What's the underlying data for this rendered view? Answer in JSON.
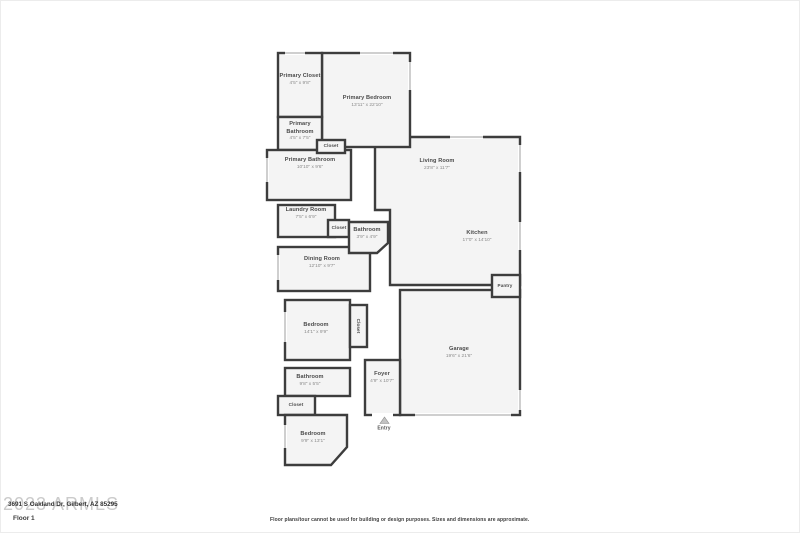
{
  "page": {
    "address": "3691 S Oakland Dr, Gilbert, AZ 85295",
    "floor_label": "Floor 1",
    "watermark": "2023 ARMLS",
    "entry_label": "Entry",
    "disclaimer": "Floor plans/tour cannot be used for building or design purposes. Sizes and dimensions are approximate."
  },
  "colors": {
    "wall": "#3d3d3d",
    "room_fill": "#f4f4f4",
    "window_line": "#9f9f9f",
    "watermark": "#cbcbcb",
    "label_text": "#4a4a4a",
    "dims_text": "#8a8a8a"
  },
  "rooms": [
    {
      "name": "Primary Closet",
      "dims": "4'5\" x 9'8\""
    },
    {
      "name": "Primary Bedroom",
      "dims": "13'11\" x 22'10\""
    },
    {
      "name": "Primary Bathroom",
      "dims": "4'5\" x 7'5\""
    },
    {
      "name": "Closet",
      "dims": ""
    },
    {
      "name": "Primary Bathroom",
      "dims": "10'10\" x 9'6\""
    },
    {
      "name": "Laundry Room",
      "dims": "7'5\" x 6'9\""
    },
    {
      "name": "Closet",
      "dims": ""
    },
    {
      "name": "Bathroom",
      "dims": "3'9\" x 4'9\""
    },
    {
      "name": "Living Room",
      "dims": "23'8\" x 11'7\""
    },
    {
      "name": "Kitchen",
      "dims": "17'0\" x 14'10\""
    },
    {
      "name": "Pantry",
      "dims": ""
    },
    {
      "name": "Dining Room",
      "dims": "12'10\" x 9'7\""
    },
    {
      "name": "Bedroom",
      "dims": "14'1\" x 9'9\""
    },
    {
      "name": "Closet",
      "dims": ""
    },
    {
      "name": "Garage",
      "dims": "19'6\" x 21'6\""
    },
    {
      "name": "Foyer",
      "dims": "4'9\" x 10'7\""
    },
    {
      "name": "Bathroom",
      "dims": "9'8\" x 5'5\""
    },
    {
      "name": "Closet",
      "dims": ""
    },
    {
      "name": "Bedroom",
      "dims": "9'9\" x 13'1\""
    }
  ]
}
